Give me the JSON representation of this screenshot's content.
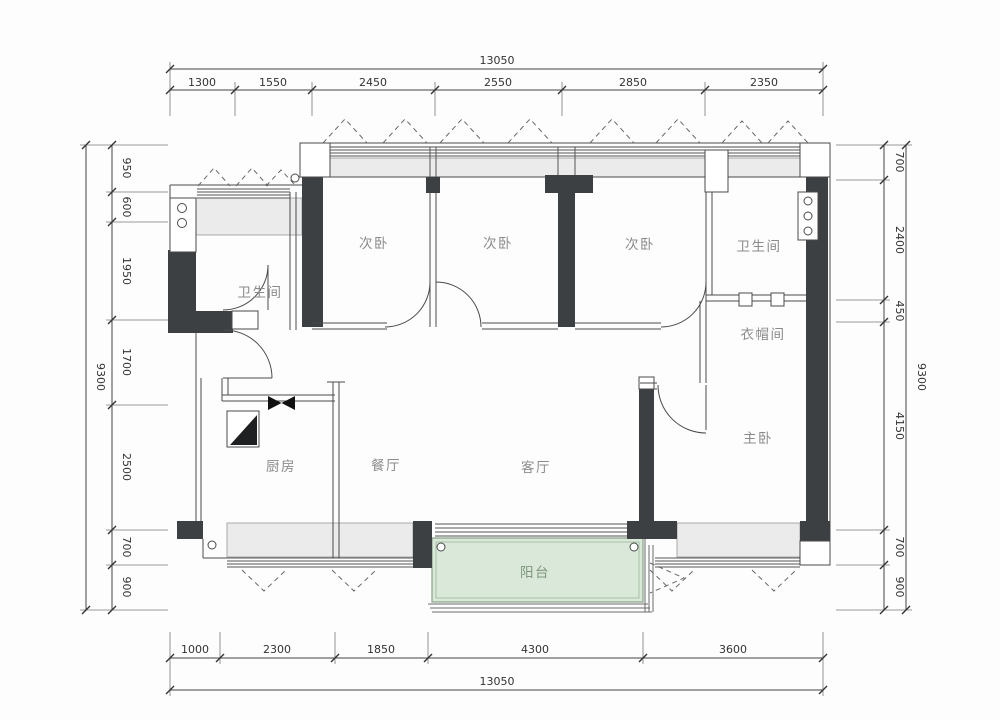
{
  "title": "apartment-floor-plan",
  "rooms": [
    "次卧",
    "次卧",
    "次卧",
    "卫生间",
    "卫生间",
    "衣帽间",
    "主卧",
    "厨房",
    "餐厅",
    "客厅",
    "阳台"
  ],
  "dims": {
    "top": {
      "total": "13050",
      "segments": [
        "1300",
        "1550",
        "2450",
        "2550",
        "2850",
        "2350"
      ]
    },
    "bottom": {
      "total": "13050",
      "segments": [
        "1000",
        "2300",
        "1850",
        "4300",
        "3600"
      ]
    },
    "left": {
      "total": "9300",
      "segments": [
        "950",
        "600",
        "1950",
        "1700",
        "2500",
        "700",
        "900"
      ]
    },
    "right": {
      "total": "9300",
      "segments": [
        "700",
        "2400",
        "450",
        "4150",
        "700",
        "900"
      ]
    }
  },
  "colors": {
    "wall": "#3d4043",
    "window_fill": "#ebebeb",
    "balcony_fill": "#d9e8d9",
    "balcony_border": "#86a386",
    "line": "#4a4a4a",
    "dim_text": "#333333",
    "room_text": "#8b8b8b"
  }
}
